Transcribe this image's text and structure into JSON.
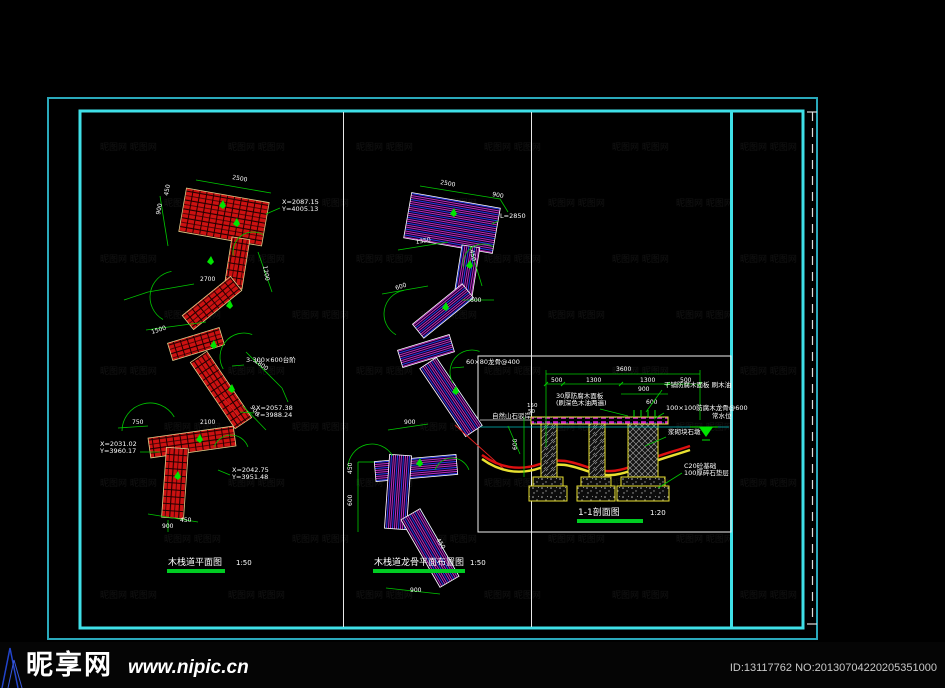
{
  "watermark": {
    "site_name": "昵享网",
    "site_url": "www.nipic.cn",
    "id_text": "ID:13117762 NO:20130704220205351000",
    "tile": "昵图网"
  },
  "colors": {
    "frame_outer": "#2aa9bb",
    "frame_inner": "#3fe0e8",
    "partition": "#e8e8e8",
    "dim_green": "#00c800",
    "bright_green": "#00e400",
    "deck_red": "#cc1111",
    "keel_magenta": "#d030d0",
    "keel_blue": "#3040ff",
    "cad_yellow": "#e8e030",
    "white": "#ffffff"
  },
  "titles": {
    "left": {
      "text": "木栈道平面图",
      "scale": "1:50",
      "x": 168,
      "y": 565,
      "sx": 236,
      "bar": [
        167,
        569,
        58,
        4
      ]
    },
    "middle": {
      "text": "木栈道龙骨平面布置图",
      "scale": "1:50",
      "x": 374,
      "y": 565,
      "sx": 470,
      "bar": [
        373,
        569,
        92,
        4
      ]
    },
    "section": {
      "text": "1-1剖面图",
      "scale": "1:20",
      "x": 578,
      "y": 515,
      "sx": 650,
      "bar": [
        577,
        519,
        66,
        4
      ]
    }
  },
  "plans": {
    "left": {
      "pattern": "redHatch",
      "outline": "#e0cc88",
      "segments": [
        [
          224,
          217,
          84,
          44,
          10
        ],
        [
          237,
          263,
          50,
          18,
          99
        ],
        [
          212,
          303,
          62,
          18,
          141
        ],
        [
          196,
          344,
          54,
          18,
          163
        ],
        [
          221,
          390,
          80,
          20,
          56
        ],
        [
          192,
          442,
          86,
          20,
          172
        ],
        [
          175,
          483,
          70,
          22,
          94
        ]
      ],
      "symbols": [
        [
          219,
          206
        ],
        [
          233,
          224
        ],
        [
          207,
          262
        ],
        [
          226,
          306
        ],
        [
          210,
          346
        ],
        [
          228,
          390
        ],
        [
          196,
          440
        ],
        [
          174,
          477
        ]
      ],
      "dim_lines": [
        [
          196,
          180,
          271,
          193
        ],
        [
          160,
          196,
          168,
          246
        ],
        [
          258,
          252,
          272,
          292
        ],
        [
          148,
          292,
          194,
          284
        ],
        [
          146,
          330,
          206,
          322
        ],
        [
          246,
          352,
          282,
          388
        ],
        [
          243,
          406,
          266,
          430
        ],
        [
          118,
          428,
          148,
          426
        ],
        [
          148,
          514,
          198,
          522
        ],
        [
          168,
          520,
          168,
          532
        ],
        [
          124,
          300,
          148,
          292
        ],
        [
          282,
          388,
          288,
          402
        ]
      ],
      "arcs": [
        [
          253,
          252,
          20,
          170,
          300
        ],
        [
          176,
          297,
          26,
          120,
          260
        ],
        [
          244,
          357,
          24,
          150,
          290
        ],
        [
          150,
          431,
          28,
          180,
          330
        ],
        [
          231,
          453,
          18,
          200,
          340
        ]
      ],
      "dim_labels": [
        [
          "2500",
          232,
          179,
          10
        ],
        [
          "450",
          168,
          196,
          -80
        ],
        [
          "900",
          160,
          215,
          -80
        ],
        [
          "1200",
          263,
          266,
          80
        ],
        [
          "2700",
          200,
          281,
          0
        ],
        [
          "1500",
          152,
          334,
          -18
        ],
        [
          "1800",
          254,
          362,
          35
        ],
        [
          "900",
          250,
          407,
          56
        ],
        [
          "750",
          132,
          424,
          0
        ],
        [
          "2100",
          200,
          424,
          0
        ],
        [
          "900",
          162,
          528,
          0
        ],
        [
          "450",
          180,
          522,
          0
        ]
      ],
      "leaders": [
        {
          "x": 282,
          "y": 204,
          "lines": [
            "X=2087.15",
            "Y=4005.13"
          ],
          "pts": [
            266,
            214,
            280,
            208
          ]
        },
        {
          "x": 246,
          "y": 362,
          "lines": [
            "3-300×600台阶"
          ],
          "pts": [
            232,
            366,
            244,
            365
          ]
        },
        {
          "x": 256,
          "y": 410,
          "lines": [
            "X=2057.38",
            "Y=3988.24"
          ],
          "pts": [
            240,
            412,
            254,
            413
          ]
        },
        {
          "x": 100,
          "y": 446,
          "lines": [
            "X=2031.02",
            "Y=3960.17"
          ],
          "pts": [
            160,
            452,
            140,
            452
          ]
        },
        {
          "x": 232,
          "y": 472,
          "lines": [
            "X=2042.75",
            "Y=3951.48"
          ],
          "pts": [
            218,
            470,
            230,
            475
          ]
        }
      ],
      "centerlines": [
        [
          223,
          397,
          242,
          421
        ]
      ]
    },
    "middle": {
      "pattern": "keel",
      "outline": "#ffffff",
      "segments": [
        [
          452,
          223,
          90,
          46,
          10
        ],
        [
          467,
          271,
          50,
          18,
          99
        ],
        [
          443,
          311,
          64,
          18,
          141
        ],
        [
          426,
          351,
          54,
          18,
          163
        ],
        [
          451,
          397,
          82,
          20,
          56
        ],
        [
          416,
          468,
          82,
          20,
          175
        ],
        [
          398,
          492,
          74,
          22,
          94
        ],
        [
          430,
          548,
          78,
          22,
          60
        ]
      ],
      "symbols": [
        [
          450,
          214
        ],
        [
          466,
          266
        ],
        [
          442,
          308
        ],
        [
          452,
          392
        ],
        [
          416,
          464
        ]
      ],
      "dim_lines": [
        [
          420,
          186,
          500,
          199
        ],
        [
          398,
          250,
          448,
          242
        ],
        [
          382,
          294,
          428,
          286
        ],
        [
          462,
          300,
          494,
          300
        ],
        [
          388,
          430,
          428,
          424
        ],
        [
          358,
          462,
          374,
          462
        ],
        [
          358,
          462,
          358,
          532
        ],
        [
          386,
          588,
          440,
          594
        ],
        [
          470,
          246,
          482,
          286
        ],
        [
          500,
          199,
          508,
          212
        ]
      ],
      "arcs": [
        [
          483,
          264,
          20,
          170,
          300
        ],
        [
          408,
          314,
          24,
          120,
          260
        ],
        [
          472,
          372,
          22,
          150,
          290
        ],
        [
          372,
          468,
          24,
          180,
          330
        ],
        [
          452,
          476,
          18,
          200,
          340
        ]
      ],
      "dim_labels": [
        [
          "2500",
          440,
          184,
          10
        ],
        [
          "900",
          492,
          196,
          10
        ],
        [
          "1350",
          416,
          244,
          -10
        ],
        [
          "600",
          396,
          290,
          -18
        ],
        [
          "450",
          470,
          250,
          80
        ],
        [
          "600",
          470,
          302,
          0
        ],
        [
          "900",
          404,
          424,
          0
        ],
        [
          "450",
          352,
          474,
          -90
        ],
        [
          "600",
          352,
          506,
          -90
        ],
        [
          "900",
          410,
          592,
          0
        ],
        [
          "450",
          436,
          540,
          56
        ]
      ],
      "leaders": [
        {
          "x": 500,
          "y": 218,
          "lines": [
            "L=2850"
          ],
          "pts": [
            492,
            224,
            498,
            221
          ]
        },
        {
          "x": 466,
          "y": 364,
          "lines": [
            "60×80龙骨@400"
          ],
          "pts": [
            452,
            368,
            464,
            367
          ]
        }
      ],
      "centerlines": [
        [
          455,
          425,
          505,
          470
        ]
      ]
    }
  },
  "section": {
    "box": [
      478,
      356,
      253,
      176
    ],
    "deck": [
      531,
      417,
      137,
      7
    ],
    "deck_ext_line": [
      480,
      420,
      531,
      420
    ],
    "waterline": [
      480,
      427,
      729,
      427
    ],
    "piers": [
      [
        541,
        424,
        16,
        53
      ],
      [
        589,
        424,
        16,
        53
      ]
    ],
    "pier_cross": [
      628,
      424,
      30,
      53
    ],
    "caps": [
      [
        533,
        477,
        30,
        9
      ],
      [
        581,
        477,
        30,
        9
      ],
      [
        621,
        477,
        44,
        9
      ]
    ],
    "pads": [
      [
        529,
        486,
        38,
        15
      ],
      [
        577,
        486,
        38,
        15
      ],
      [
        617,
        486,
        52,
        15
      ]
    ],
    "ground_path": "M482,455 C500,468 520,471 540,464 C560,457 572,462 590,468 C608,474 622,471 640,463 C656,456 672,452 690,446",
    "deck_ticks": [
      634,
      641,
      648,
      655
    ],
    "dims": {
      "total": {
        "label": "3600",
        "x": 616,
        "y": 371,
        "line": [
          546,
          374,
          700,
          374
        ]
      },
      "chain_ticks": [
        546,
        563,
        621,
        668,
        700
      ],
      "chain_y": 384,
      "chain_labels": [
        [
          "500",
          551,
          382
        ],
        [
          "1300",
          586,
          382
        ],
        [
          "1300",
          640,
          382
        ],
        [
          "500",
          680,
          382
        ]
      ],
      "sub": {
        "label": "900",
        "x": 638,
        "y": 391,
        "line": [
          621,
          394,
          668,
          394
        ]
      },
      "extra_label": {
        "label": "600",
        "x": 646,
        "y": 404
      },
      "vertical": {
        "label": "600",
        "x": 517,
        "y": 450,
        "line": [
          524,
          417,
          524,
          477
        ]
      },
      "small": [
        [
          "150",
          527,
          407
        ],
        [
          "50",
          528,
          413
        ]
      ]
    },
    "water_symbol": {
      "line": [
        690,
        427,
        718,
        427
      ],
      "tri": [
        699,
        427,
        713,
        427,
        706,
        437
      ],
      "line2": [
        702,
        440,
        710,
        440
      ]
    },
    "annotations": [
      {
        "x": 556,
        "y": 398,
        "lines": [
          "30厚防腐木面板",
          "(刷深色木油两遍)"
        ],
        "pts": [
          600,
          409,
          628,
          416
        ]
      },
      {
        "x": 664,
        "y": 387,
        "lines": [
          "干铺防腐木面板 刷木油"
        ],
        "pts": [
          662,
          390,
          646,
          412
        ]
      },
      {
        "x": 666,
        "y": 410,
        "lines": [
          "100×100防腐木龙骨@600"
        ],
        "pts": [
          664,
          413,
          654,
          419
        ]
      },
      {
        "x": 684,
        "y": 468,
        "lines": [
          "C20砼基础",
          "100厚碎石垫层"
        ],
        "pts": [
          682,
          473,
          658,
          488
        ]
      },
      {
        "x": 668,
        "y": 434,
        "lines": [
          "浆砌块石墩"
        ],
        "pts": [
          666,
          437,
          645,
          446
        ]
      },
      {
        "x": 492,
        "y": 418,
        "lines": [
          "自然山石驳岸"
        ],
        "pts": [
          508,
          426,
          520,
          454
        ]
      },
      {
        "x": 712,
        "y": 418,
        "lines": [
          "常水位"
        ],
        "pts": []
      }
    ]
  }
}
